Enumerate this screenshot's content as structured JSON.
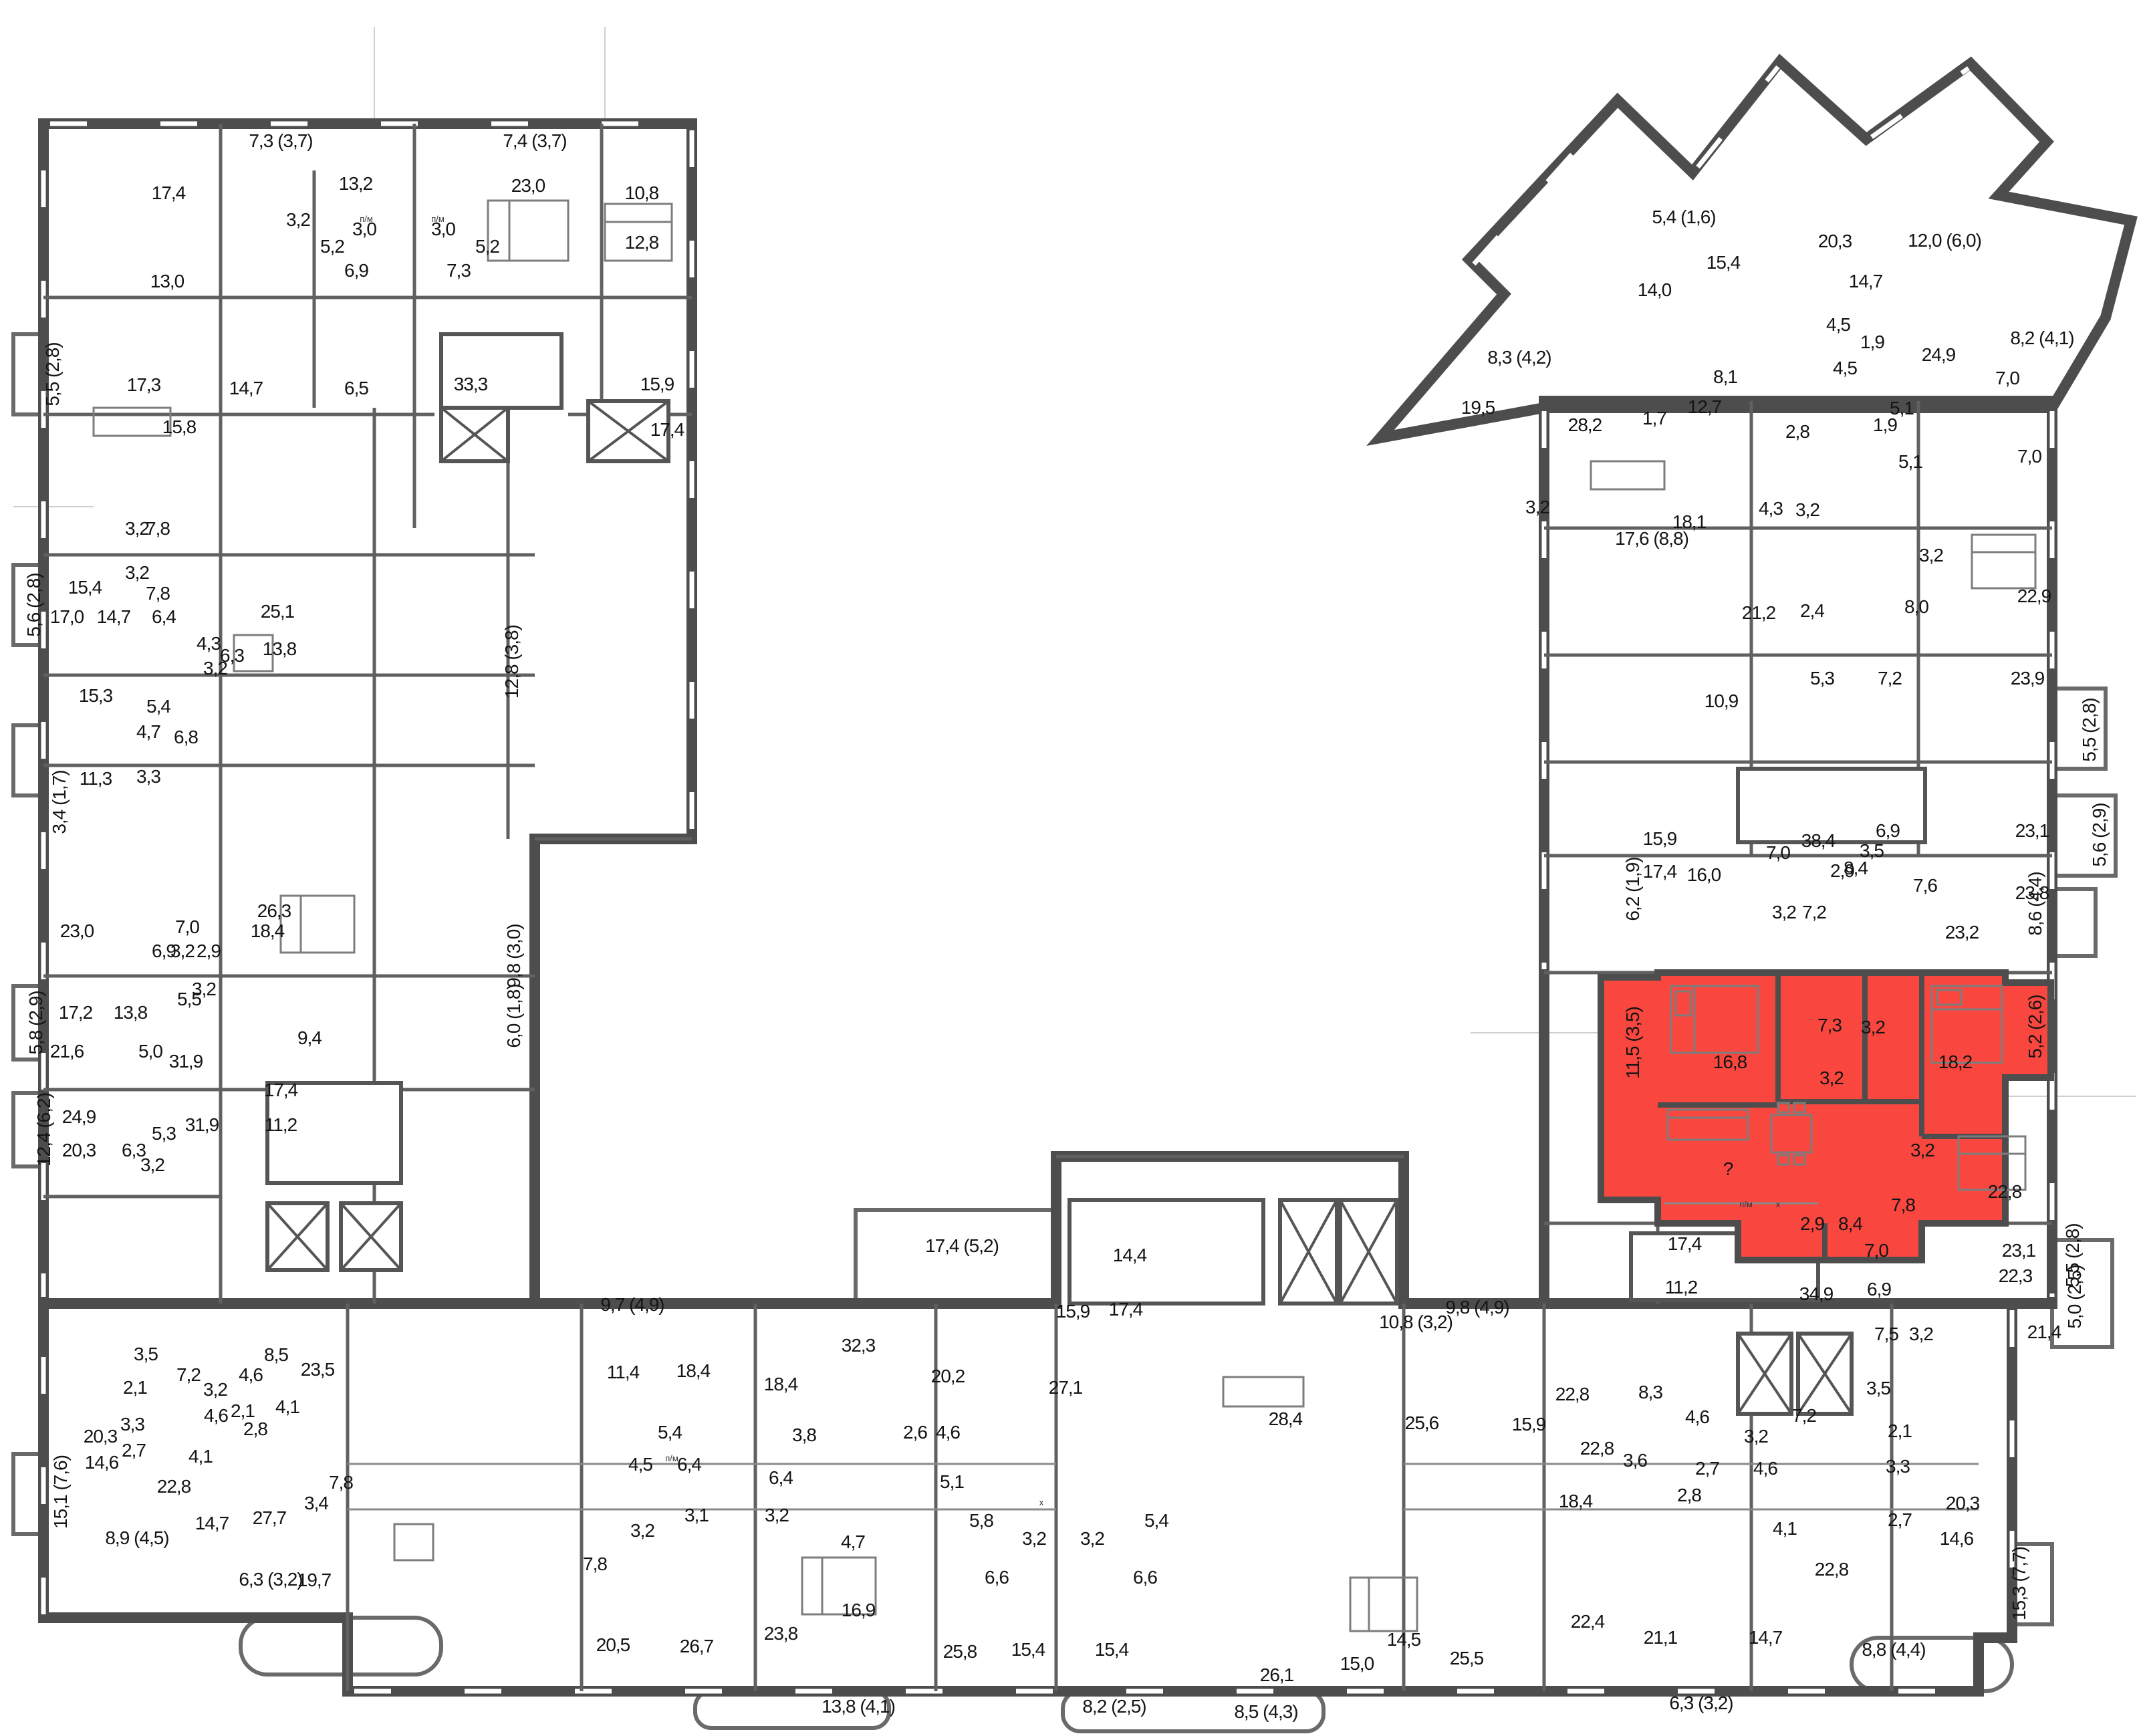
{
  "colors": {
    "highlight": "#f9473f",
    "wall": "#4d4d4d",
    "background": "#ffffff",
    "text": "#141414"
  },
  "highlighted_apartment": {
    "fill": "#f9473f",
    "room_areas": [
      "16,8",
      "7,3",
      "3,2",
      "18,2",
      "3,2",
      "?",
      "2,9",
      "8,4",
      "11,5 (3,5)",
      "5,2 (2,6)"
    ]
  },
  "appliance_markers": [
    [
      2612,
      1806,
      "п/м"
    ],
    [
      2660,
      1806,
      "х"
    ],
    [
      548,
      332,
      "п/м"
    ],
    [
      655,
      332,
      "п/м"
    ],
    [
      1005,
      2186,
      "п/м"
    ],
    [
      1558,
      2252,
      "х"
    ]
  ],
  "labels": [
    [
      420,
      220,
      "7,3 (3,7)",
      0
    ],
    [
      800,
      220,
      "7,4 (3,7)",
      0
    ],
    [
      252,
      298,
      "17,4",
      0
    ],
    [
      532,
      284,
      "13,2",
      0
    ],
    [
      790,
      287,
      "23,0",
      0
    ],
    [
      960,
      298,
      "10,8",
      0
    ],
    [
      446,
      338,
      "3,2",
      0
    ],
    [
      545,
      352,
      "3,0",
      0
    ],
    [
      663,
      352,
      "3,0",
      0
    ],
    [
      497,
      378,
      "5,2",
      0
    ],
    [
      729,
      378,
      "5,2",
      0
    ],
    [
      960,
      372,
      "12,8",
      0
    ],
    [
      250,
      430,
      "13,0",
      0
    ],
    [
      533,
      414,
      "6,9",
      0
    ],
    [
      686,
      414,
      "7,3",
      0
    ],
    [
      215,
      585,
      "17,3",
      0
    ],
    [
      368,
      590,
      "14,7",
      0
    ],
    [
      533,
      590,
      "6,5",
      0
    ],
    [
      704,
      584,
      "33,3",
      0
    ],
    [
      983,
      584,
      "15,9",
      0
    ],
    [
      268,
      648,
      "15,8",
      0
    ],
    [
      998,
      652,
      "17,4",
      0
    ],
    [
      88,
      560,
      "5,5 (2,8)",
      1
    ],
    [
      205,
      800,
      "3,2",
      0
    ],
    [
      236,
      800,
      "7,8",
      0
    ],
    [
      205,
      866,
      "3,2",
      0
    ],
    [
      236,
      897,
      "7,8",
      0
    ],
    [
      60,
      905,
      "5,6 (2,8)",
      1
    ],
    [
      127,
      888,
      "15,4",
      0
    ],
    [
      100,
      932,
      "17,0",
      0
    ],
    [
      170,
      932,
      "14,7",
      0
    ],
    [
      245,
      932,
      "6,4",
      0
    ],
    [
      415,
      924,
      "25,1",
      0
    ],
    [
      312,
      972,
      "4,3",
      0
    ],
    [
      347,
      990,
      "6,3",
      0
    ],
    [
      322,
      1009,
      "3,2",
      0
    ],
    [
      418,
      980,
      "13,8",
      0
    ],
    [
      775,
      990,
      "12,8 (3,8)",
      1
    ],
    [
      143,
      1050,
      "15,3",
      0
    ],
    [
      237,
      1066,
      "5,4",
      0
    ],
    [
      222,
      1104,
      "4,7",
      0
    ],
    [
      278,
      1112,
      "6,8",
      0
    ],
    [
      98,
      1200,
      "3,4 (1,7)",
      1
    ],
    [
      143,
      1174,
      "11,3",
      0
    ],
    [
      222,
      1171,
      "3,3",
      0
    ],
    [
      410,
      1372,
      "26,3",
      0
    ],
    [
      115,
      1402,
      "23,0",
      0
    ],
    [
      280,
      1396,
      "7,0",
      0
    ],
    [
      400,
      1402,
      "18,4",
      0
    ],
    [
      245,
      1432,
      "6,9",
      0
    ],
    [
      273,
      1432,
      "3,2",
      0
    ],
    [
      312,
      1432,
      "2,9",
      0
    ],
    [
      778,
      1430,
      "9,8 (3,0)",
      1
    ],
    [
      113,
      1524,
      "17,2",
      0
    ],
    [
      195,
      1524,
      "13,8",
      0
    ],
    [
      283,
      1504,
      "5,5",
      0
    ],
    [
      305,
      1489,
      "3,2",
      0
    ],
    [
      778,
      1520,
      "6,0 (1,8)",
      1
    ],
    [
      63,
      1530,
      "5,8 (2,9)",
      1
    ],
    [
      100,
      1582,
      "21,6",
      0
    ],
    [
      225,
      1582,
      "5,0",
      0
    ],
    [
      278,
      1597,
      "31,9",
      0
    ],
    [
      463,
      1562,
      "9,4",
      0
    ],
    [
      420,
      1640,
      "17,4",
      0
    ],
    [
      118,
      1680,
      "24,9",
      0
    ],
    [
      245,
      1705,
      "5,3",
      0
    ],
    [
      302,
      1692,
      "31,9",
      0
    ],
    [
      420,
      1692,
      "11,2",
      0
    ],
    [
      75,
      1690,
      "12,4 (6,2)",
      1
    ],
    [
      118,
      1730,
      "20,3",
      0
    ],
    [
      200,
      1730,
      "6,3",
      0
    ],
    [
      228,
      1752,
      "3,2",
      0
    ],
    [
      218,
      2035,
      "3,5",
      0
    ],
    [
      282,
      2066,
      "7,2",
      0
    ],
    [
      413,
      2036,
      "8,5",
      0
    ],
    [
      475,
      2058,
      "23,5",
      0
    ],
    [
      202,
      2085,
      "2,1",
      0
    ],
    [
      322,
      2088,
      "3,2",
      0
    ],
    [
      375,
      2066,
      "4,6",
      0
    ],
    [
      198,
      2140,
      "3,3",
      0
    ],
    [
      323,
      2127,
      "4,6",
      0
    ],
    [
      363,
      2120,
      "2,1",
      0
    ],
    [
      382,
      2147,
      "2,8",
      0
    ],
    [
      430,
      2114,
      "4,1",
      0
    ],
    [
      150,
      2158,
      "20,3",
      0
    ],
    [
      200,
      2179,
      "2,7",
      0
    ],
    [
      152,
      2197,
      "14,6",
      0
    ],
    [
      300,
      2188,
      "4,1",
      0
    ],
    [
      100,
      2232,
      "15,1 (7,6)",
      1
    ],
    [
      260,
      2233,
      "22,8",
      0
    ],
    [
      317,
      2288,
      "14,7",
      0
    ],
    [
      403,
      2280,
      "27,7",
      0
    ],
    [
      510,
      2227,
      "7,8",
      0
    ],
    [
      473,
      2258,
      "3,4",
      0
    ],
    [
      205,
      2310,
      "8,9 (4,5)",
      0
    ],
    [
      405,
      2372,
      "6,3 (3,2)",
      0
    ],
    [
      470,
      2373,
      "19,7",
      0
    ],
    [
      946,
      1961,
      "9,7 (4,9)",
      0
    ],
    [
      932,
      2062,
      "11,4",
      0
    ],
    [
      1037,
      2060,
      "18,4",
      0
    ],
    [
      1168,
      2080,
      "18,4",
      0
    ],
    [
      1284,
      2022,
      "32,3",
      0
    ],
    [
      1418,
      2068,
      "20,2",
      0
    ],
    [
      1439,
      1873,
      "17,4 (5,2)",
      0
    ],
    [
      1605,
      1971,
      "15,9",
      0
    ],
    [
      1684,
      1968,
      "17,4",
      0
    ],
    [
      1690,
      1887,
      "14,4",
      0
    ],
    [
      1923,
      2132,
      "28,4",
      0
    ],
    [
      2127,
      2138,
      "25,6",
      0
    ],
    [
      2118,
      1987,
      "10,8 (3,2)",
      0
    ],
    [
      2210,
      1965,
      "9,8 (4,9)",
      0
    ],
    [
      958,
      2200,
      "4,5",
      0
    ],
    [
      1002,
      2152,
      "5,4",
      0
    ],
    [
      1031,
      2200,
      "6,4",
      0
    ],
    [
      1203,
      2156,
      "3,8",
      0
    ],
    [
      1369,
      2152,
      "2,6",
      0
    ],
    [
      1418,
      2152,
      "4,6",
      0
    ],
    [
      1594,
      2085,
      "27,1",
      0
    ],
    [
      1168,
      2220,
      "6,4",
      0
    ],
    [
      1042,
      2276,
      "3,1",
      0
    ],
    [
      1162,
      2276,
      "3,2",
      0
    ],
    [
      961,
      2299,
      "3,2",
      0
    ],
    [
      890,
      2349,
      "7,8",
      0
    ],
    [
      1276,
      2316,
      "4,7",
      0
    ],
    [
      1424,
      2226,
      "5,1",
      0
    ],
    [
      1468,
      2284,
      "5,8",
      0
    ],
    [
      1730,
      2284,
      "5,4",
      0
    ],
    [
      1547,
      2311,
      "3,2",
      0
    ],
    [
      1634,
      2311,
      "3,2",
      0
    ],
    [
      1491,
      2369,
      "6,6",
      0
    ],
    [
      1713,
      2369,
      "6,6",
      0
    ],
    [
      1284,
      2418,
      "16,9",
      0
    ],
    [
      1168,
      2453,
      "23,8",
      0
    ],
    [
      917,
      2470,
      "20,5",
      0
    ],
    [
      1042,
      2472,
      "26,7",
      0
    ],
    [
      1436,
      2480,
      "25,8",
      0
    ],
    [
      1538,
      2477,
      "15,4",
      0
    ],
    [
      1663,
      2477,
      "15,4",
      0
    ],
    [
      1284,
      2562,
      "13,8 (4,1)",
      0
    ],
    [
      1667,
      2562,
      "8,2 (2,5)",
      0
    ],
    [
      1894,
      2570,
      "8,5 (4,3)",
      0
    ],
    [
      1910,
      2515,
      "26,1",
      0
    ],
    [
      2030,
      2498,
      "15,0",
      0
    ],
    [
      2100,
      2462,
      "14,5",
      0
    ],
    [
      2194,
      2490,
      "25,5",
      0
    ],
    [
      2287,
      2140,
      "15,9",
      0
    ],
    [
      2389,
      2176,
      "22,8",
      0
    ],
    [
      2352,
      2095,
      "22,8",
      0
    ],
    [
      2469,
      2092,
      "8,3",
      0
    ],
    [
      2539,
      2129,
      "4,6",
      0
    ],
    [
      2627,
      2158,
      "3,2",
      0
    ],
    [
      2699,
      2127,
      "7,2",
      0
    ],
    [
      2810,
      2086,
      "3,5",
      0
    ],
    [
      2842,
      2150,
      "2,1",
      0
    ],
    [
      2446,
      2194,
      "3,6",
      0
    ],
    [
      2554,
      2206,
      "2,7",
      0
    ],
    [
      2527,
      2246,
      "2,8",
      0
    ],
    [
      2641,
      2206,
      "4,6",
      0
    ],
    [
      2839,
      2203,
      "3,3",
      0
    ],
    [
      2357,
      2255,
      "18,4",
      0
    ],
    [
      2936,
      2258,
      "20,3",
      0
    ],
    [
      2842,
      2283,
      "2,7",
      0
    ],
    [
      2927,
      2311,
      "14,6",
      0
    ],
    [
      2670,
      2296,
      "4,1",
      0
    ],
    [
      2740,
      2357,
      "22,8",
      0
    ],
    [
      2484,
      2459,
      "21,1",
      0
    ],
    [
      2641,
      2459,
      "14,7",
      0
    ],
    [
      2375,
      2435,
      "22,4",
      0
    ],
    [
      2545,
      2557,
      "6,3 (3,2)",
      0
    ],
    [
      2833,
      2477,
      "8,8 (4,4)",
      0
    ],
    [
      3030,
      2369,
      "15,3 (7,7)",
      1
    ],
    [
      2807,
      1880,
      "7,0",
      0
    ],
    [
      3020,
      1880,
      "23,1",
      0
    ],
    [
      2822,
      2005,
      "7,5",
      0
    ],
    [
      2874,
      2005,
      "3,2",
      0
    ],
    [
      3058,
      2002,
      "21,4",
      0
    ],
    [
      2515,
      1935,
      "11,2",
      0
    ],
    [
      2717,
      1945,
      "34,9",
      0
    ],
    [
      3110,
      1878,
      "5,5 (2,8)",
      1
    ],
    [
      2876,
      1730,
      "3,2",
      0
    ],
    [
      2847,
      1812,
      "7,8",
      0
    ],
    [
      2999,
      1792,
      "22,8",
      0
    ],
    [
      2811,
      1938,
      "6,9",
      0
    ],
    [
      3015,
      1918,
      "22,3",
      0
    ],
    [
      3113,
      1940,
      "5,0 (2,5)",
      1
    ],
    [
      2520,
      1870,
      "17,4",
      0
    ],
    [
      2588,
      1598,
      "16,8",
      0
    ],
    [
      2737,
      1543,
      "7,3",
      0
    ],
    [
      2802,
      1546,
      "3,2",
      0
    ],
    [
      2925,
      1598,
      "18,2",
      0
    ],
    [
      2740,
      1622,
      "3,2",
      0
    ],
    [
      2585,
      1758,
      "?",
      0
    ],
    [
      2711,
      1840,
      "2,9",
      0
    ],
    [
      2768,
      1840,
      "8,4",
      0
    ],
    [
      2452,
      1560,
      "11,5 (3,5)",
      1
    ],
    [
      3054,
      1536,
      "5,2 (2,6)",
      1
    ],
    [
      2549,
      1318,
      "16,0",
      0
    ],
    [
      2669,
      1374,
      "3,2",
      0
    ],
    [
      2714,
      1374,
      "7,2",
      0
    ],
    [
      2756,
      1312,
      "2,9",
      0
    ],
    [
      2800,
      1282,
      "3,5",
      0
    ],
    [
      2660,
      1285,
      "7,0",
      0
    ],
    [
      2776,
      1308,
      "8,4",
      0
    ],
    [
      2935,
      1404,
      "23,2",
      0
    ],
    [
      2880,
      1334,
      "7,6",
      0
    ],
    [
      3040,
      1345,
      "23,8",
      0
    ],
    [
      2452,
      1330,
      "6,2 (1,9)",
      1
    ],
    [
      3054,
      1352,
      "8,6 (4,4)",
      1
    ],
    [
      2631,
      926,
      "21,2",
      0
    ],
    [
      2711,
      923,
      "2,4",
      0
    ],
    [
      2867,
      917,
      "8,0",
      0
    ],
    [
      3043,
      901,
      "22,9",
      0
    ],
    [
      2889,
      840,
      "3,2",
      0
    ],
    [
      2726,
      1024,
      "5,3",
      0
    ],
    [
      2827,
      1024,
      "7,2",
      0
    ],
    [
      3033,
      1024,
      "23,9",
      0
    ],
    [
      3135,
      1092,
      "5,5 (2,8)",
      1
    ],
    [
      2575,
      1058,
      "10,9",
      0
    ],
    [
      2824,
      1252,
      "6,9",
      0
    ],
    [
      3040,
      1252,
      "23,1",
      0
    ],
    [
      3150,
      1249,
      "5,6 (2,9)",
      1
    ],
    [
      2483,
      1264,
      "15,9",
      0
    ],
    [
      2720,
      1267,
      "38,4",
      0
    ],
    [
      2483,
      1313,
      "17,4",
      0
    ],
    [
      2858,
      700,
      "5,1",
      0
    ],
    [
      3036,
      692,
      "7,0",
      0
    ],
    [
      2550,
      618,
      "12,7",
      0
    ],
    [
      2689,
      655,
      "2,8",
      0
    ],
    [
      2820,
      645,
      "1,9",
      0
    ],
    [
      2527,
      790,
      "18,1",
      0
    ],
    [
      2649,
      770,
      "4,3",
      0
    ],
    [
      2704,
      772,
      "3,2",
      0
    ],
    [
      2471,
      815,
      "17,6 (8,8)",
      0
    ],
    [
      2760,
      560,
      "4,5",
      0
    ],
    [
      2519,
      334,
      "5,4 (1,6)",
      0
    ],
    [
      2578,
      402,
      "15,4",
      0
    ],
    [
      2475,
      443,
      "14,0",
      0
    ],
    [
      2745,
      370,
      "20,3",
      0
    ],
    [
      2273,
      544,
      "8,3 (4,2)",
      0
    ],
    [
      2211,
      619,
      "19,5",
      0
    ],
    [
      2371,
      645,
      "28,2",
      0
    ],
    [
      2475,
      635,
      "1,7",
      0
    ],
    [
      2581,
      573,
      "8,1",
      0
    ],
    [
      2909,
      369,
      "12,0 (6,0)",
      0
    ],
    [
      2791,
      430,
      "14,7",
      0
    ],
    [
      2900,
      540,
      "24,9",
      0
    ],
    [
      3055,
      515,
      "8,2 (4,1)",
      0
    ],
    [
      2801,
      521,
      "1,9",
      0
    ],
    [
      2845,
      620,
      "5,1",
      0
    ],
    [
      2750,
      495,
      "4,5",
      0
    ],
    [
      3003,
      575,
      "7,0",
      0
    ],
    [
      2300,
      768,
      "3,2",
      0
    ]
  ]
}
